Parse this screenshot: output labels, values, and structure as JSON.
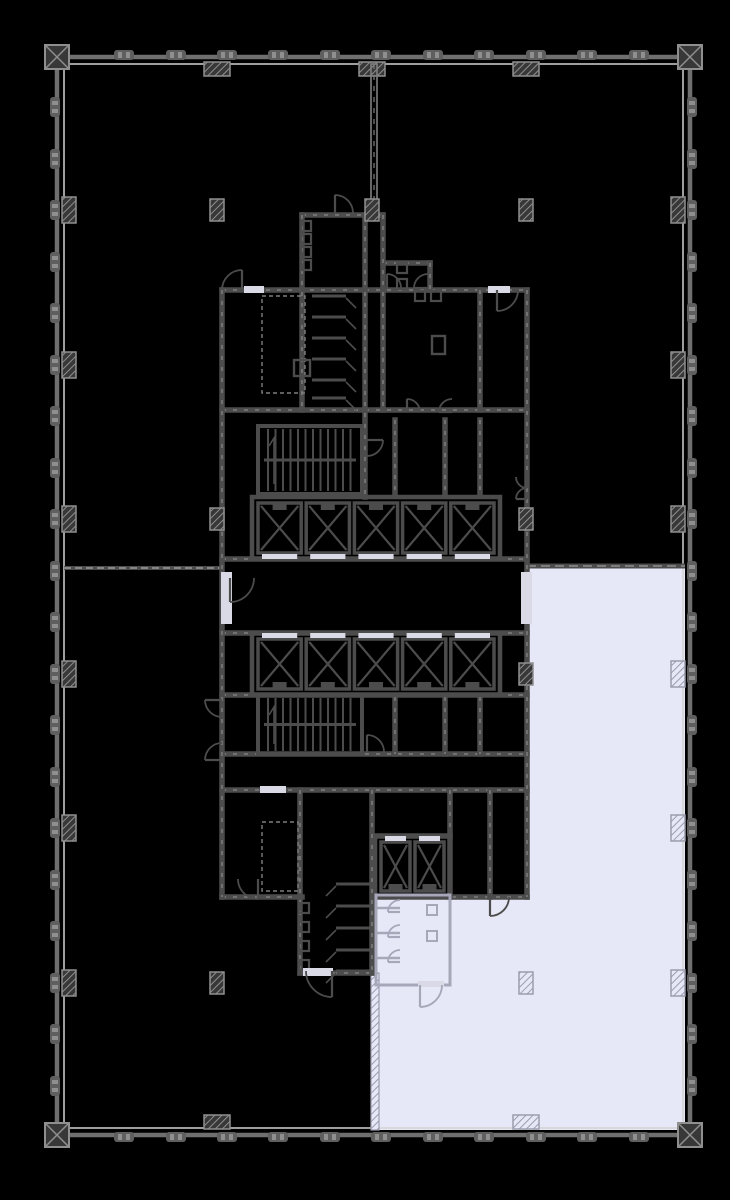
{
  "canvas": {
    "width": 730,
    "height": 1200
  },
  "colors": {
    "background": "#000000",
    "suite_fill": "#e7e8f7",
    "wall": "#4c4c4c",
    "wall_outer": "#6f6f6f",
    "wall_inner_line": "#d2d2d2",
    "wall_dash": "#969696",
    "light_partition": "#a6a8ba",
    "threshold": "#d9dae6",
    "column_fill": "#383838",
    "column_stroke": "#8f8f8f",
    "column_light_stroke": "#9b9dae",
    "mullion": "#5f5f5f",
    "mullion_tick": "#8f8f8f"
  },
  "suite": {
    "label": "highlighted-suite",
    "points": [
      [
        527,
        566
      ],
      [
        685,
        566
      ],
      [
        685,
        1130
      ],
      [
        377,
        1130
      ],
      [
        377,
        897
      ],
      [
        527,
        897
      ]
    ]
  },
  "perimeter": {
    "outer": [
      57,
      57,
      633,
      1078
    ],
    "inner": [
      64,
      64,
      619,
      1064
    ]
  },
  "mullions": {
    "top_x": [
      124,
      176,
      227,
      278,
      330,
      381,
      433,
      484,
      536,
      587,
      639
    ],
    "bottom_x": [
      124,
      176,
      227,
      278,
      330,
      381,
      433,
      484,
      536,
      587,
      639
    ],
    "left_y": [
      107,
      159,
      210,
      262,
      313,
      365,
      416,
      468,
      519,
      571,
      622,
      674,
      725,
      777,
      828,
      880,
      931,
      983,
      1034,
      1086
    ],
    "right_y": [
      107,
      159,
      210,
      262,
      313,
      365,
      416,
      468,
      519,
      571,
      622,
      674,
      725,
      777,
      828,
      880,
      931,
      983,
      1034,
      1086
    ]
  },
  "corners": [
    [
      57,
      57
    ],
    [
      690,
      57
    ],
    [
      57,
      1135
    ],
    [
      690,
      1135
    ]
  ],
  "engaged_columns": {
    "left_dark_y": [
      210,
      365,
      519,
      674,
      828,
      983
    ],
    "right_dark_y": [
      210,
      365,
      519
    ],
    "right_light_y": [
      674,
      828,
      983
    ],
    "top_dark_x": [
      217,
      372,
      526
    ],
    "bottom_dark_x": [
      217
    ],
    "bottom_light_x": [
      526
    ]
  },
  "interior_columns": {
    "dark": [
      [
        217,
        210
      ],
      [
        372,
        210
      ],
      [
        526,
        210
      ],
      [
        217,
        519
      ],
      [
        526,
        519
      ],
      [
        526,
        674
      ],
      [
        217,
        983
      ]
    ],
    "light": [
      [
        526,
        983
      ]
    ]
  },
  "demising": {
    "vertical_top": {
      "x": 371,
      "y1": 64,
      "y2": 215,
      "w": 6
    },
    "left_horizontal": {
      "y": 568,
      "x1": 64,
      "x2": 222
    },
    "suite_top": {
      "y": 566,
      "x1": 527,
      "x2": 685
    },
    "suite_left_lower": {
      "x": 371,
      "y1": 973,
      "y2": 1130,
      "w": 8
    }
  },
  "core": {
    "h_walls": [
      [
        222,
        290,
        527,
        290
      ],
      [
        302,
        215,
        383,
        215
      ],
      [
        383,
        263,
        430,
        263
      ],
      [
        222,
        410,
        527,
        410
      ],
      [
        222,
        559,
        527,
        559
      ],
      [
        222,
        633,
        527,
        633
      ],
      [
        222,
        695,
        527,
        695
      ],
      [
        222,
        754,
        527,
        754
      ],
      [
        222,
        790,
        527,
        790
      ],
      [
        375,
        836,
        450,
        836
      ],
      [
        222,
        897,
        302,
        897
      ],
      [
        375,
        897,
        527,
        897
      ],
      [
        300,
        973,
        372,
        973
      ]
    ],
    "v_walls": [
      [
        222,
        290,
        222,
        897
      ],
      [
        527,
        290,
        527,
        897
      ],
      [
        302,
        215,
        302,
        410
      ],
      [
        365,
        215,
        365,
        497
      ],
      [
        383,
        215,
        383,
        410
      ],
      [
        430,
        263,
        430,
        290
      ],
      [
        480,
        290,
        480,
        410
      ],
      [
        395,
        420,
        395,
        494
      ],
      [
        445,
        420,
        445,
        494
      ],
      [
        480,
        420,
        480,
        494
      ],
      [
        395,
        697,
        395,
        754
      ],
      [
        445,
        697,
        445,
        754
      ],
      [
        480,
        697,
        480,
        754
      ],
      [
        300,
        790,
        300,
        973
      ],
      [
        372,
        790,
        372,
        973
      ],
      [
        450,
        790,
        450,
        897
      ],
      [
        490,
        790,
        490,
        897
      ]
    ],
    "dashed_rooms": [
      [
        262,
        296,
        43,
        97
      ],
      [
        262,
        822,
        36,
        69
      ]
    ]
  },
  "elevator_banks": [
    {
      "name": "elevator-bank-upper",
      "x": 252,
      "y": 497,
      "w": 248,
      "h": 62,
      "shafts": 5,
      "doors": "bottom"
    },
    {
      "name": "elevator-bank-lower",
      "x": 252,
      "y": 633,
      "w": 248,
      "h": 62,
      "shafts": 5,
      "doors": "top"
    },
    {
      "name": "service-elevators",
      "x": 375,
      "y": 836,
      "w": 75,
      "h": 61,
      "shafts": 2,
      "doors": "top"
    }
  ],
  "stairs": [
    {
      "name": "stair-upper",
      "x": 258,
      "y": 426,
      "w": 104,
      "h": 68
    },
    {
      "name": "stair-lower",
      "x": 258,
      "y": 695,
      "w": 104,
      "h": 59
    }
  ],
  "stall_rows": [
    {
      "x1": 312,
      "x2": 346,
      "ys": [
        296,
        317,
        338,
        359,
        380,
        398
      ],
      "door": "right"
    },
    {
      "x1": 336,
      "x2": 370,
      "ys": [
        884,
        906,
        928,
        950,
        971
      ],
      "door": "left"
    }
  ],
  "fixtures": {
    "dark_squares": [
      [
        306,
        226
      ],
      [
        306,
        239
      ],
      [
        306,
        252
      ],
      [
        306,
        265
      ],
      [
        402,
        268
      ],
      [
        402,
        284
      ],
      [
        420,
        296
      ],
      [
        436,
        296
      ],
      [
        304,
        908
      ],
      [
        304,
        927
      ],
      [
        304,
        946
      ],
      [
        304,
        965
      ]
    ],
    "cabinets": [
      [
        432,
        336,
        13,
        18
      ],
      [
        294,
        360,
        16,
        16
      ]
    ]
  },
  "pantry": {
    "x": 376,
    "y": 895,
    "w": 74,
    "h": 90,
    "stall_x2": 400,
    "stall_ys": [
      908,
      933,
      958
    ],
    "fixture_squares": [
      [
        432,
        910
      ],
      [
        432,
        936
      ]
    ],
    "opening": [
      418,
      981,
      26,
      6
    ]
  },
  "doors_dark": [
    [
      242,
      290,
      20,
      180,
      90
    ],
    [
      335,
      213,
      18,
      0,
      90
    ],
    [
      387,
      288,
      14,
      0,
      90
    ],
    [
      428,
      288,
      14,
      90,
      180
    ],
    [
      497,
      290,
      21,
      0,
      -90
    ],
    [
      367,
      440,
      16,
      -90,
      0
    ],
    [
      407,
      412,
      13,
      0,
      90
    ],
    [
      452,
      412,
      13,
      90,
      180
    ],
    [
      230,
      578,
      24,
      0,
      -90
    ],
    [
      527,
      477,
      11,
      180,
      270
    ],
    [
      527,
      499,
      11,
      90,
      180
    ],
    [
      367,
      752,
      17,
      0,
      90
    ],
    [
      222,
      700,
      17,
      270,
      180
    ],
    [
      222,
      760,
      17,
      90,
      180
    ],
    [
      258,
      879,
      20,
      180,
      270
    ],
    [
      332,
      971,
      26,
      180,
      270
    ],
    [
      490,
      897,
      19,
      0,
      -90
    ]
  ],
  "doors_light": [
    [
      400,
      912,
      12,
      90,
      180
    ],
    [
      400,
      937,
      12,
      90,
      180
    ],
    [
      400,
      962,
      12,
      90,
      180
    ],
    [
      420,
      985,
      22,
      0,
      -90
    ]
  ],
  "thresholds_dark_side": [
    [
      221,
      572,
      11,
      52
    ],
    [
      521,
      572,
      11,
      52
    ],
    [
      488,
      286,
      22,
      7
    ],
    [
      260,
      786,
      26,
      7
    ],
    [
      303,
      968,
      30,
      8
    ],
    [
      244,
      286,
      20,
      7
    ]
  ]
}
